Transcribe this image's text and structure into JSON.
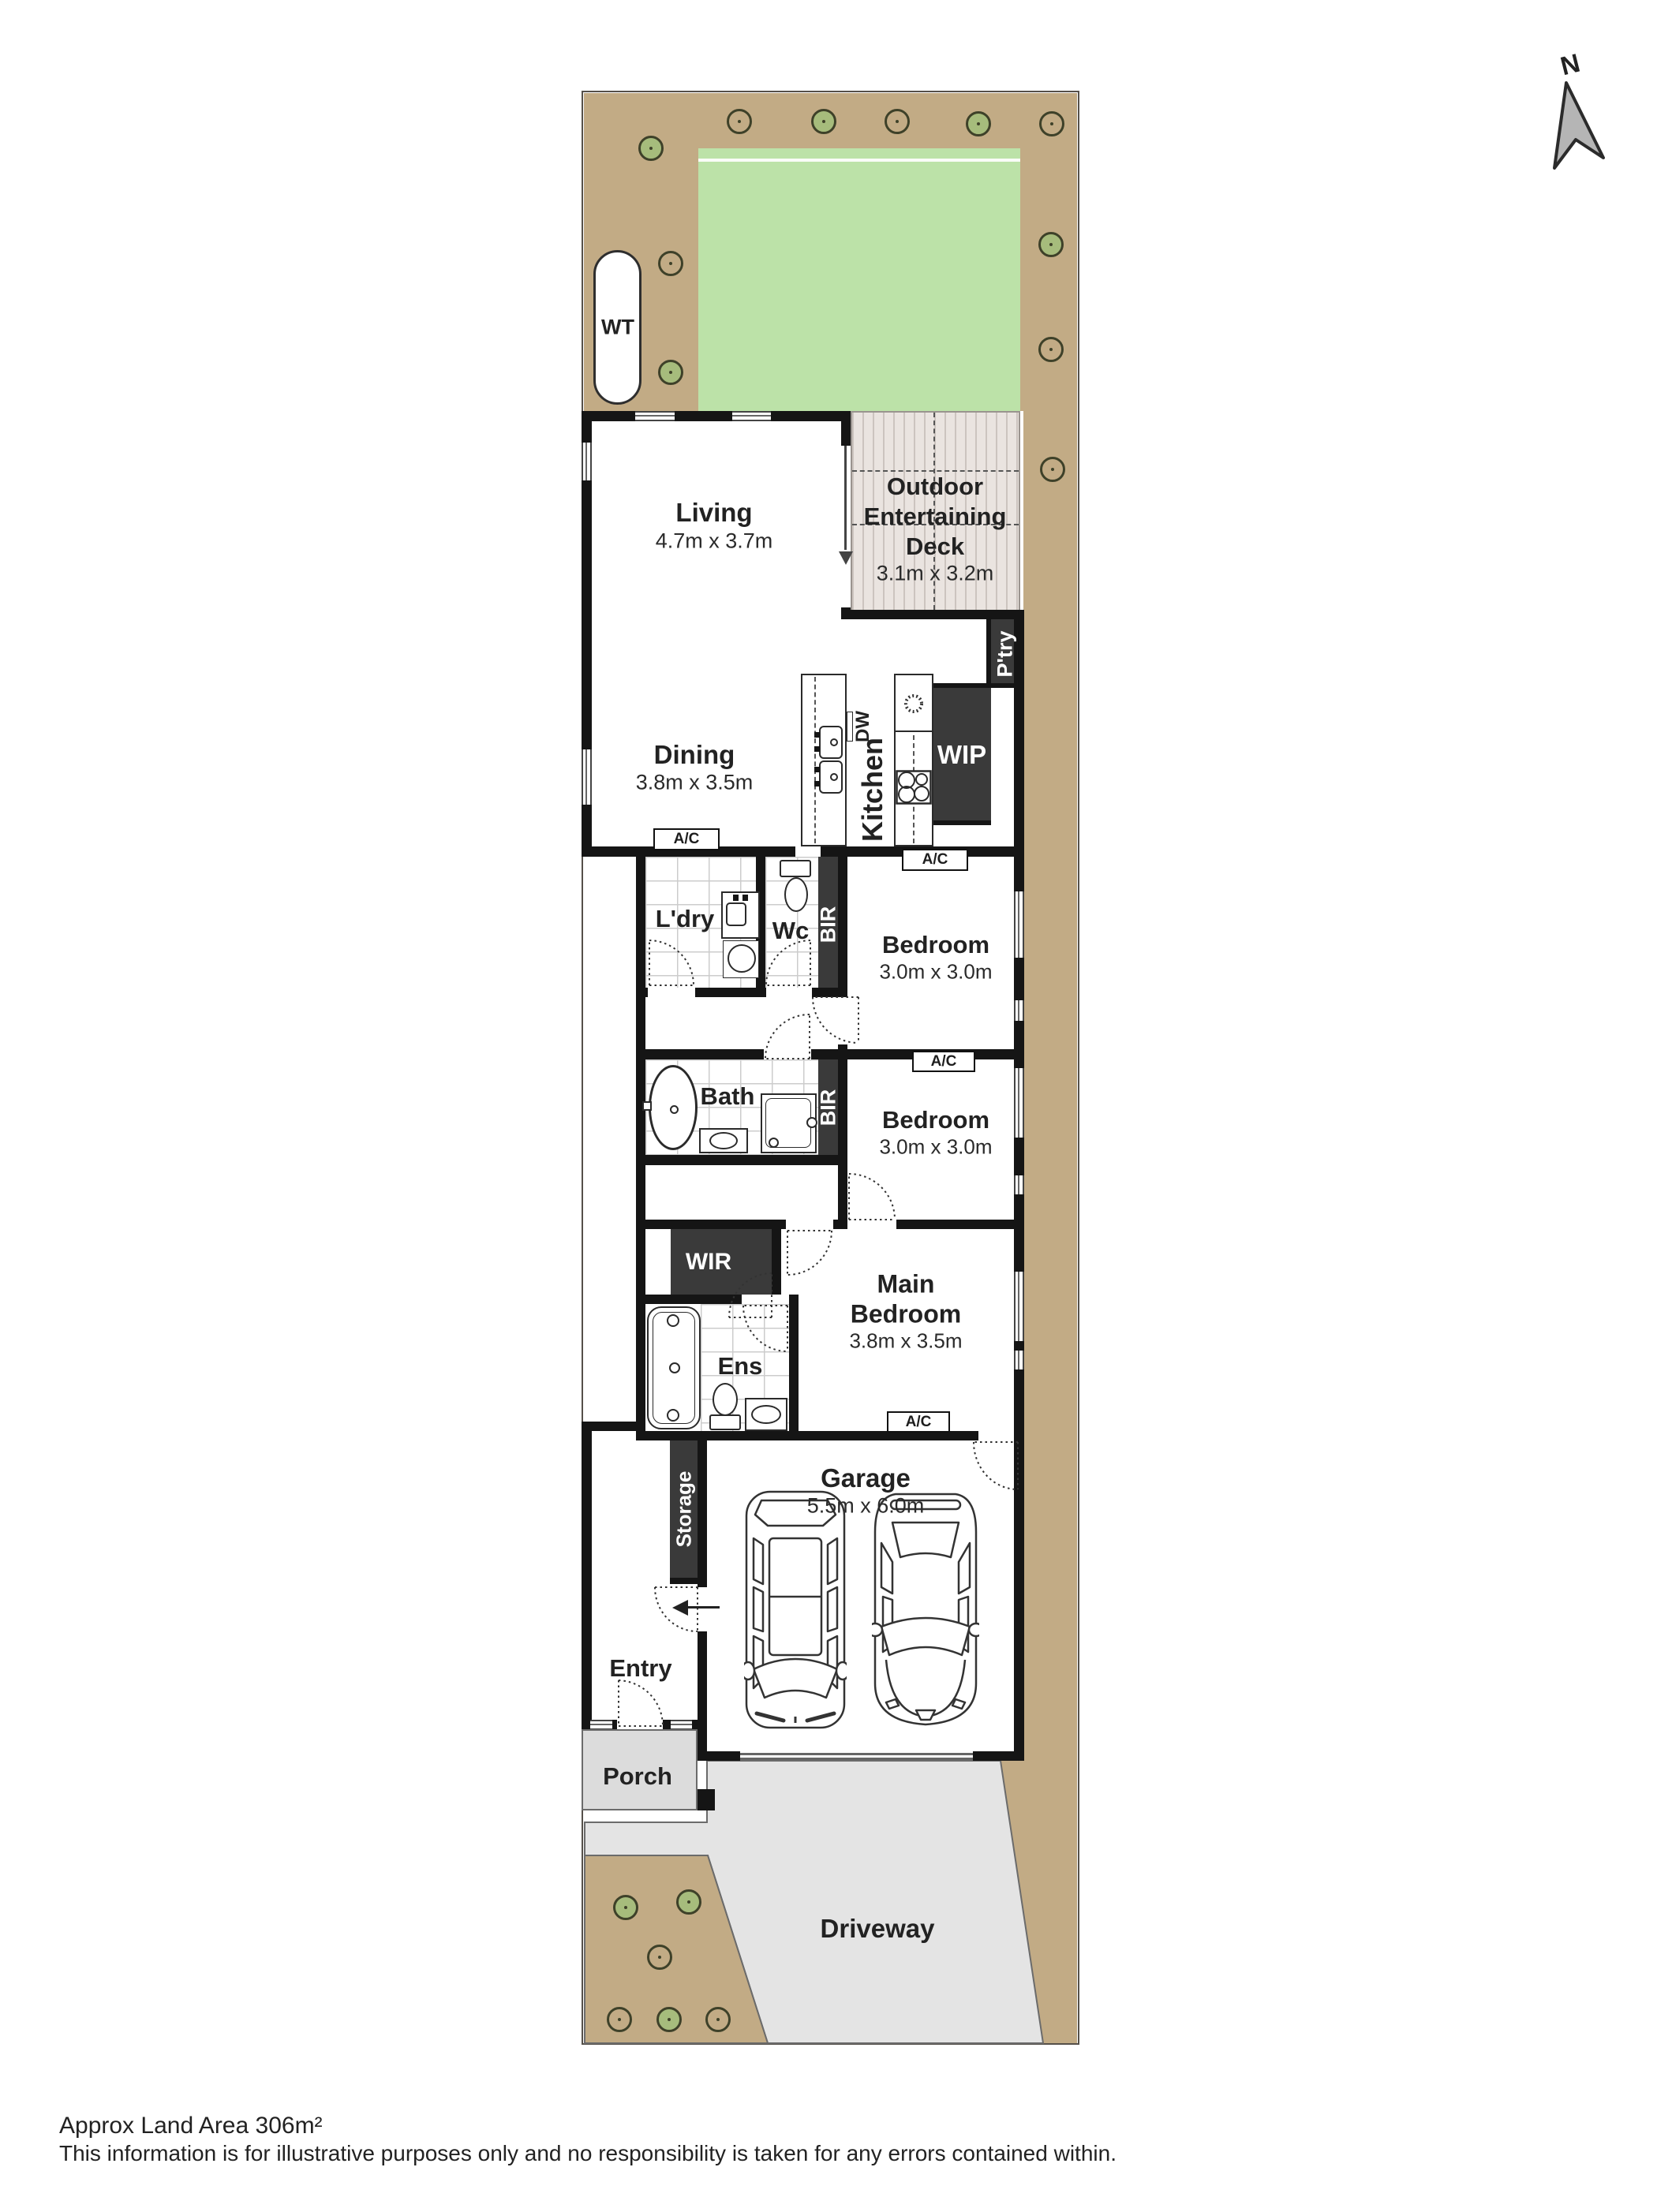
{
  "north": "N",
  "wt": "WT",
  "living": {
    "name": "Living",
    "dims": "4.7m x 3.7m"
  },
  "deck": {
    "line1": "Outdoor",
    "line2": "Entertaining",
    "line3": "Deck",
    "dims": "3.1m x 3.2m"
  },
  "pantry": "P'try",
  "wip": "WIP",
  "kitchen": "Kitchen",
  "dw": "DW",
  "dining": {
    "name": "Dining",
    "dims": "3.8m x 3.5m"
  },
  "ac": "A/C",
  "ldry": "L'dry",
  "wc": "Wc",
  "bir": "BIR",
  "bedroom1": {
    "name": "Bedroom",
    "dims": "3.0m x 3.0m"
  },
  "bath": "Bath",
  "bedroom2": {
    "name": "Bedroom",
    "dims": "3.0m x 3.0m"
  },
  "wir": "WIR",
  "ens": "Ens",
  "main_bedroom": {
    "line1": "Main",
    "line2": "Bedroom",
    "dims": "3.8m x 3.5m"
  },
  "garage": {
    "name": "Garage",
    "dims": "5.5m x 6.0m"
  },
  "storage": "Storage",
  "entry": "Entry",
  "porch": "Porch",
  "driveway": "Driveway",
  "footer": {
    "line1": "Approx Land Area 306m²",
    "line2": "This information is for illustrative purposes only and no responsibility is taken for any errors contained within."
  }
}
